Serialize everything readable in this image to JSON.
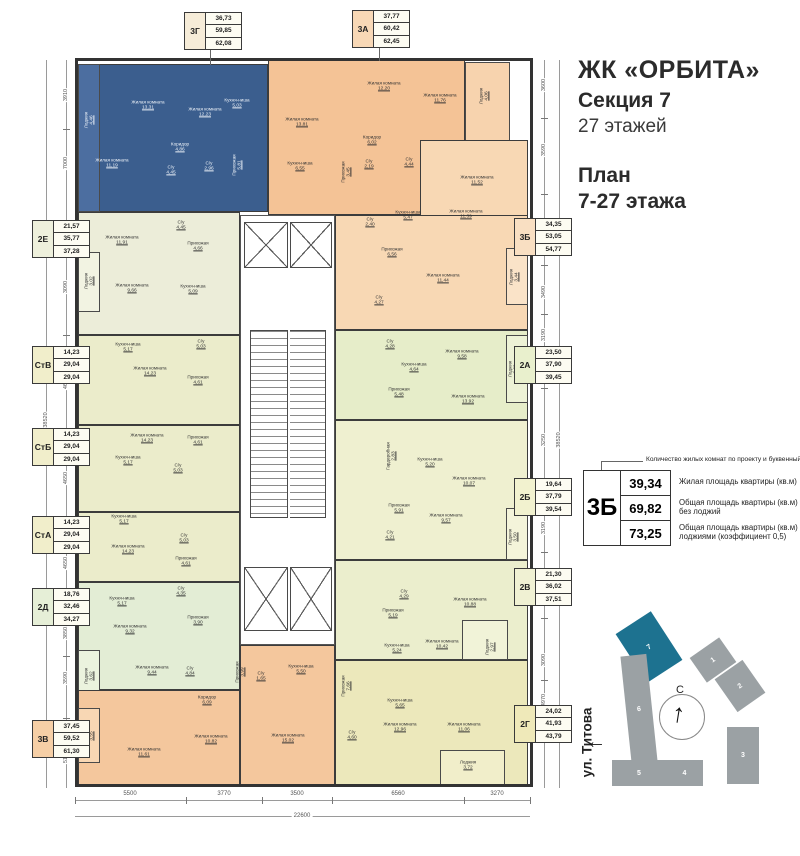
{
  "header": {
    "complex": "ЖК «ОРБИТА»",
    "section": "Секция 7",
    "floors": "27 этажей",
    "plan_line1": "План",
    "plan_line2": "7-27 этажа"
  },
  "legend": {
    "note": "Количество жилых комнат по проекту и буквенный код",
    "code": "3Б",
    "v1": "39,34",
    "v2": "69,82",
    "v3": "73,25",
    "l1": "Жилая площадь квартиры (кв.м)",
    "l2": "Общая площадь квартиры (кв.м) без лоджий",
    "l3": "Общая площадь квартиры (кв.м) с лоджиями (коэффициент 0,5)"
  },
  "site": {
    "street": "ул. Титова",
    "north": "С",
    "highlight_color": "#1d7290",
    "building_color": "#9ba1a4",
    "buildings": [
      {
        "n": "7",
        "x": 628,
        "y": 618,
        "w": 42,
        "h": 58,
        "rot": -33,
        "hl": true
      },
      {
        "n": "6",
        "x": 626,
        "y": 655,
        "w": 26,
        "h": 108,
        "rot": -6,
        "hl": false
      },
      {
        "n": "5",
        "x": 612,
        "y": 760,
        "w": 54,
        "h": 26,
        "rot": 0,
        "hl": false
      },
      {
        "n": "4",
        "x": 666,
        "y": 760,
        "w": 37,
        "h": 26,
        "rot": 0,
        "hl": false
      },
      {
        "n": "3",
        "x": 727,
        "y": 727,
        "w": 32,
        "h": 57,
        "rot": 0,
        "hl": false
      },
      {
        "n": "2",
        "x": 723,
        "y": 666,
        "w": 34,
        "h": 40,
        "rot": -35,
        "hl": false
      },
      {
        "n": "1",
        "x": 695,
        "y": 645,
        "w": 36,
        "h": 30,
        "rot": -35,
        "hl": false
      }
    ]
  },
  "plan": {
    "wall_color": "#3c3c3c",
    "apartment_blue": "#3b5e8e",
    "label_boxes": [
      {
        "code": "3Г",
        "values": [
          "36,73",
          "59,85",
          "62,08"
        ],
        "x": 184,
        "y": 12,
        "cc": "#f6ecd8"
      },
      {
        "code": "3А",
        "values": [
          "37,77",
          "60,42",
          "62,45"
        ],
        "x": 352,
        "y": 10,
        "cc": "#f8d8b6"
      },
      {
        "code": "2Е",
        "values": [
          "21,57",
          "35,77",
          "37,28"
        ],
        "x": 32,
        "y": 220,
        "cc": "#eef0dc"
      },
      {
        "code": "СтВ",
        "values": [
          "14,23",
          "29,04",
          "29,04"
        ],
        "x": 32,
        "y": 346,
        "cc": "#f1eecb"
      },
      {
        "code": "СтБ",
        "values": [
          "14,23",
          "29,04",
          "29,04"
        ],
        "x": 32,
        "y": 428,
        "cc": "#f1eecb"
      },
      {
        "code": "СтА",
        "values": [
          "14,23",
          "29,04",
          "29,04"
        ],
        "x": 32,
        "y": 516,
        "cc": "#f1eecb"
      },
      {
        "code": "2Д",
        "values": [
          "18,76",
          "32,46",
          "34,27"
        ],
        "x": 32,
        "y": 588,
        "cc": "#e6efd7"
      },
      {
        "code": "3В",
        "values": [
          "37,45",
          "59,52",
          "61,30"
        ],
        "x": 32,
        "y": 720,
        "cc": "#f6cfa6"
      },
      {
        "code": "3Б",
        "values": [
          "34,35",
          "53,05",
          "54,77"
        ],
        "x": 514,
        "y": 218,
        "cc": "#f9dfc2"
      },
      {
        "code": "2А",
        "values": [
          "23,50",
          "37,90",
          "39,45"
        ],
        "x": 514,
        "y": 346,
        "cc": "#e9f0cd"
      },
      {
        "code": "2Б",
        "values": [
          "19,64",
          "37,79",
          "39,54"
        ],
        "x": 514,
        "y": 478,
        "cc": "#f2f2cf"
      },
      {
        "code": "2В",
        "values": [
          "21,30",
          "36,02",
          "37,51"
        ],
        "x": 514,
        "y": 568,
        "cc": "#f0f1d3"
      },
      {
        "code": "2Г",
        "values": [
          "24,02",
          "41,93",
          "43,79"
        ],
        "x": 514,
        "y": 705,
        "cc": "#efe9b9"
      }
    ],
    "rooms": [
      {
        "n": "Лоджия",
        "a": "4,46",
        "x": 89,
        "y": 120,
        "r": 1,
        "c": 1
      },
      {
        "n": "Жилая комната",
        "a": "13,31",
        "x": 148,
        "y": 105,
        "c": 1
      },
      {
        "n": "Жилая комната",
        "a": "12,23",
        "x": 205,
        "y": 112,
        "c": 1
      },
      {
        "n": "Кухня-ниша",
        "a": "5,03",
        "x": 237,
        "y": 103,
        "c": 1
      },
      {
        "n": "Жилая комната",
        "a": "11,19",
        "x": 112,
        "y": 163,
        "c": 1
      },
      {
        "n": "Коридор",
        "a": "4,86",
        "x": 180,
        "y": 147,
        "c": 1
      },
      {
        "n": "С/у",
        "a": "4,45",
        "x": 171,
        "y": 170,
        "c": 1
      },
      {
        "n": "С/у",
        "a": "2,96",
        "x": 209,
        "y": 166,
        "c": 1
      },
      {
        "n": "Прихожая",
        "a": "5,81",
        "x": 237,
        "y": 165,
        "r": 1,
        "c": 1
      },
      {
        "n": "Жилая комната",
        "a": "13,81",
        "x": 302,
        "y": 122
      },
      {
        "n": "Кухня-ниша",
        "a": "6,55",
        "x": 300,
        "y": 166
      },
      {
        "n": "Жилая комната",
        "a": "12,20",
        "x": 384,
        "y": 86
      },
      {
        "n": "Жилая комната",
        "a": "11,76",
        "x": 440,
        "y": 98
      },
      {
        "n": "Лоджия",
        "a": "4,06",
        "x": 484,
        "y": 96,
        "r": 1
      },
      {
        "n": "Коридор",
        "a": "6,02",
        "x": 372,
        "y": 140
      },
      {
        "n": "Прихожая",
        "a": "3,45",
        "x": 346,
        "y": 172,
        "r": 1
      },
      {
        "n": "С/у",
        "a": "2,19",
        "x": 369,
        "y": 164
      },
      {
        "n": "С/у",
        "a": "4,44",
        "x": 409,
        "y": 162
      },
      {
        "n": "Жилая комната",
        "a": "11,52",
        "x": 477,
        "y": 180
      },
      {
        "n": "Кухня-ниша",
        "a": "5,47",
        "x": 408,
        "y": 215
      },
      {
        "n": "С/у",
        "a": "2,40",
        "x": 370,
        "y": 222
      },
      {
        "n": "Жилая комната",
        "a": "11,39",
        "x": 466,
        "y": 214
      },
      {
        "n": "Прихожая",
        "a": "6,56",
        "x": 392,
        "y": 252
      },
      {
        "n": "Жилая комната",
        "a": "11,44",
        "x": 443,
        "y": 278
      },
      {
        "n": "Лоджия",
        "a": "3,44",
        "x": 514,
        "y": 277,
        "r": 1
      },
      {
        "n": "С/у",
        "a": "4,27",
        "x": 379,
        "y": 300
      },
      {
        "n": "Жилая комната",
        "a": "11,91",
        "x": 122,
        "y": 240
      },
      {
        "n": "Прихожая",
        "a": "4,66",
        "x": 198,
        "y": 246
      },
      {
        "n": "С/у",
        "a": "4,45",
        "x": 181,
        "y": 225
      },
      {
        "n": "Жилая комната",
        "a": "9,66",
        "x": 132,
        "y": 288
      },
      {
        "n": "Кухня-ниша",
        "a": "5,09",
        "x": 193,
        "y": 289
      },
      {
        "n": "Лоджия",
        "a": "3,02",
        "x": 89,
        "y": 281,
        "r": 1
      },
      {
        "n": "Кухня-ниша",
        "a": "5,17",
        "x": 128,
        "y": 347
      },
      {
        "n": "С/у",
        "a": "5,03",
        "x": 201,
        "y": 344
      },
      {
        "n": "Жилая комната",
        "a": "14,23",
        "x": 150,
        "y": 371
      },
      {
        "n": "Прихожая",
        "a": "4,61",
        "x": 198,
        "y": 380
      },
      {
        "n": "Жилая комната",
        "a": "14,23",
        "x": 147,
        "y": 438
      },
      {
        "n": "Прихожая",
        "a": "4,61",
        "x": 198,
        "y": 440
      },
      {
        "n": "Кухня-ниша",
        "a": "5,17",
        "x": 128,
        "y": 460
      },
      {
        "n": "С/у",
        "a": "5,03",
        "x": 178,
        "y": 468
      },
      {
        "n": "Кухня-ниша",
        "a": "5,17",
        "x": 124,
        "y": 519
      },
      {
        "n": "С/у",
        "a": "5,03",
        "x": 184,
        "y": 538
      },
      {
        "n": "Жилая комната",
        "a": "14,23",
        "x": 128,
        "y": 549
      },
      {
        "n": "Прихожая",
        "a": "4,61",
        "x": 186,
        "y": 561
      },
      {
        "n": "Кухня-ниша",
        "a": "5,17",
        "x": 122,
        "y": 601
      },
      {
        "n": "С/у",
        "a": "4,35",
        "x": 181,
        "y": 591
      },
      {
        "n": "Жилая комната",
        "a": "9,32",
        "x": 130,
        "y": 629
      },
      {
        "n": "Прихожая",
        "a": "3,90",
        "x": 198,
        "y": 620
      },
      {
        "n": "Жилая комната",
        "a": "9,44",
        "x": 152,
        "y": 670
      },
      {
        "n": "Лоджия",
        "a": "3,62",
        "x": 89,
        "y": 676,
        "r": 1
      },
      {
        "n": "С/у",
        "a": "4,84",
        "x": 190,
        "y": 671
      },
      {
        "n": "Коридор",
        "a": "6,09",
        "x": 207,
        "y": 700
      },
      {
        "n": "Прихожая",
        "a": "3,99",
        "x": 240,
        "y": 672,
        "r": 1
      },
      {
        "n": "С/у",
        "a": "1,65",
        "x": 261,
        "y": 676
      },
      {
        "n": "Кухня-ниша",
        "a": "5,50",
        "x": 301,
        "y": 669
      },
      {
        "n": "Жилая комната",
        "a": "10,82",
        "x": 211,
        "y": 739
      },
      {
        "n": "Жилая комната",
        "a": "11,61",
        "x": 144,
        "y": 752
      },
      {
        "n": "Жилая комната",
        "a": "15,02",
        "x": 288,
        "y": 738
      },
      {
        "n": "Лоджия",
        "a": "3,55",
        "x": 89,
        "y": 736,
        "r": 1
      },
      {
        "n": "С/у",
        "a": "4,28",
        "x": 390,
        "y": 344
      },
      {
        "n": "Кухня-ниша",
        "a": "4,64",
        "x": 414,
        "y": 367
      },
      {
        "n": "Жилая комната",
        "a": "9,58",
        "x": 462,
        "y": 354
      },
      {
        "n": "Прихожая",
        "a": "5,48",
        "x": 399,
        "y": 392
      },
      {
        "n": "Жилая комната",
        "a": "13,92",
        "x": 468,
        "y": 399
      },
      {
        "n": "Лоджия",
        "a": "3,09",
        "x": 513,
        "y": 369,
        "r": 1
      },
      {
        "n": "Гардеробная",
        "a": "2,83",
        "x": 391,
        "y": 456,
        "r": 1
      },
      {
        "n": "Кухня-ниша",
        "a": "5,20",
        "x": 430,
        "y": 462
      },
      {
        "n": "Жилая комната",
        "a": "10,07",
        "x": 469,
        "y": 481
      },
      {
        "n": "Прихожая",
        "a": "5,91",
        "x": 399,
        "y": 508
      },
      {
        "n": "Жилая комната",
        "a": "9,57",
        "x": 446,
        "y": 518
      },
      {
        "n": "С/у",
        "a": "4,21",
        "x": 390,
        "y": 535
      },
      {
        "n": "Лоджия",
        "a": "3,50",
        "x": 513,
        "y": 537,
        "r": 1
      },
      {
        "n": "С/у",
        "a": "4,29",
        "x": 404,
        "y": 594
      },
      {
        "n": "Жилая комната",
        "a": "10,88",
        "x": 470,
        "y": 602
      },
      {
        "n": "Прихожая",
        "a": "5,19",
        "x": 393,
        "y": 613
      },
      {
        "n": "Кухня-ниша",
        "a": "5,24",
        "x": 397,
        "y": 648
      },
      {
        "n": "Жилая комната",
        "a": "10,42",
        "x": 442,
        "y": 644
      },
      {
        "n": "Лоджия",
        "a": "2,97",
        "x": 490,
        "y": 647,
        "r": 1
      },
      {
        "n": "Прихожая",
        "a": "7,66",
        "x": 346,
        "y": 686,
        "r": 1
      },
      {
        "n": "Кухня-ниша",
        "a": "5,65",
        "x": 400,
        "y": 703
      },
      {
        "n": "С/у",
        "a": "4,60",
        "x": 352,
        "y": 735
      },
      {
        "n": "Жилая комната",
        "a": "12,96",
        "x": 400,
        "y": 727
      },
      {
        "n": "Жилая комната",
        "a": "11,06",
        "x": 464,
        "y": 727
      },
      {
        "n": "Лоджия",
        "a": "3,72",
        "x": 468,
        "y": 765
      }
    ],
    "dims": {
      "left": [
        {
          "v": "3910",
          "y": 95
        },
        {
          "v": "7000",
          "y": 163
        },
        {
          "v": "3090",
          "y": 287
        },
        {
          "v": "4650",
          "y": 383
        },
        {
          "v": "4650",
          "y": 478
        },
        {
          "v": "4650",
          "y": 563
        },
        {
          "v": "3850",
          "y": 633
        },
        {
          "v": "3590",
          "y": 678
        },
        {
          "v": "5190",
          "y": 757
        }
      ],
      "left_total": "38520",
      "right": [
        {
          "v": "3600",
          "y": 85
        },
        {
          "v": "3590",
          "y": 150
        },
        {
          "v": "5650",
          "y": 238
        },
        {
          "v": "3490",
          "y": 292
        },
        {
          "v": "3190",
          "y": 335
        },
        {
          "v": "3250",
          "y": 440
        },
        {
          "v": "3190",
          "y": 528
        },
        {
          "v": "3250",
          "y": 575
        },
        {
          "v": "3090",
          "y": 660
        },
        {
          "v": "4970",
          "y": 700
        }
      ],
      "right_total": "38520",
      "bottom": [
        {
          "v": "5500",
          "x": 130
        },
        {
          "v": "3770",
          "x": 224
        },
        {
          "v": "3500",
          "x": 297
        },
        {
          "v": "6560",
          "x": 398
        },
        {
          "v": "3270",
          "x": 497
        }
      ],
      "bottom_total": "22600"
    }
  }
}
